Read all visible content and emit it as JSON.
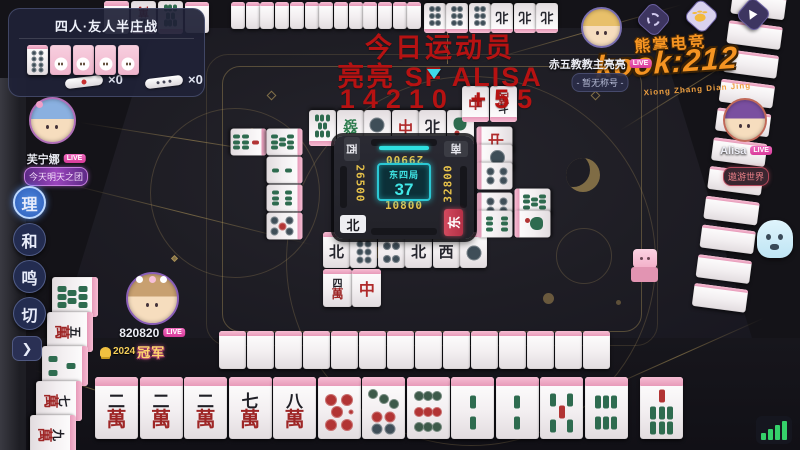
{
  "match": {
    "mode_title": "四人·友人半庄战",
    "dora_indicator": "8p",
    "riichi_stick_count": "×0",
    "honba_stick_count": "×0"
  },
  "stream_overlay": {
    "line1": "今日运动员",
    "line2": "亮亮 SF ALISA",
    "line3": "14210 +55"
  },
  "brand": {
    "banner": "熊掌电竞",
    "room": "kook:212",
    "subtitle": "Xiong Zhang Dian Jing"
  },
  "board": {
    "round_label": "东四局",
    "tiles_remaining": "37",
    "scores": {
      "top": "29900",
      "left": "26500",
      "right": "32800",
      "bottom": "10800"
    },
    "seat_winds": {
      "top": "南",
      "left": "西",
      "right": "东",
      "bottom": "北"
    }
  },
  "players": {
    "top_right": {
      "name": "赤五教教主亮亮",
      "live": "LIVE",
      "title": "- 暂无称号 -"
    },
    "left": {
      "name": "芙宁娜",
      "live": "LIVE",
      "title": "今天明天之团"
    },
    "right": {
      "name": "Alisa",
      "live": "LIVE",
      "title": "遨游世界"
    },
    "bottom": {
      "name": "820820",
      "live": "LIVE",
      "badge_year": "2024",
      "badge_label": "冠军"
    }
  },
  "action_buttons": [
    {
      "id": "sort",
      "label": "理",
      "active": true
    },
    {
      "id": "win",
      "label": "和",
      "active": false
    },
    {
      "id": "call",
      "label": "鸣",
      "active": false
    },
    {
      "id": "discard",
      "label": "切",
      "active": false
    }
  ],
  "expand_label": "❯",
  "tiles": {
    "hand": [
      "2m",
      "2m",
      "2m",
      "7m",
      "8m",
      "0p",
      "7p",
      "9p",
      "2s",
      "2s",
      "5s",
      "6s"
    ],
    "drawn": "7s",
    "left_hand_column": [
      "8s",
      "5m",
      "3s",
      "7m",
      "9m"
    ],
    "top_extra": [
      "5m",
      "8s"
    ],
    "top_meld_row": [
      "6p",
      "6p",
      "6p",
      "N",
      "N",
      "N"
    ],
    "top_wall_backs": 13,
    "bottom_wall_backs": 14,
    "right_wall_backs": 11,
    "dora_wall_backs": 4,
    "discards": {
      "top_row1": [
        "8s",
        "G",
        "1p",
        "R",
        "N",
        "1s"
      ],
      "top_row2": [
        "R",
        "7m"
      ],
      "left_col_outer": [
        "7s"
      ],
      "left_col_inner": [
        "8s",
        "2s",
        "6s"
      ],
      "left_riichi": "5p",
      "bottom_row1": [
        "N",
        "6p",
        "4p",
        "N",
        "W",
        "1p"
      ],
      "bottom_row2": [
        "4m",
        "R"
      ],
      "right_col_inner": [
        "R",
        "1p",
        "4p",
        "4p",
        "9s"
      ],
      "right_col_outer": [
        "8s",
        "1s"
      ]
    }
  }
}
